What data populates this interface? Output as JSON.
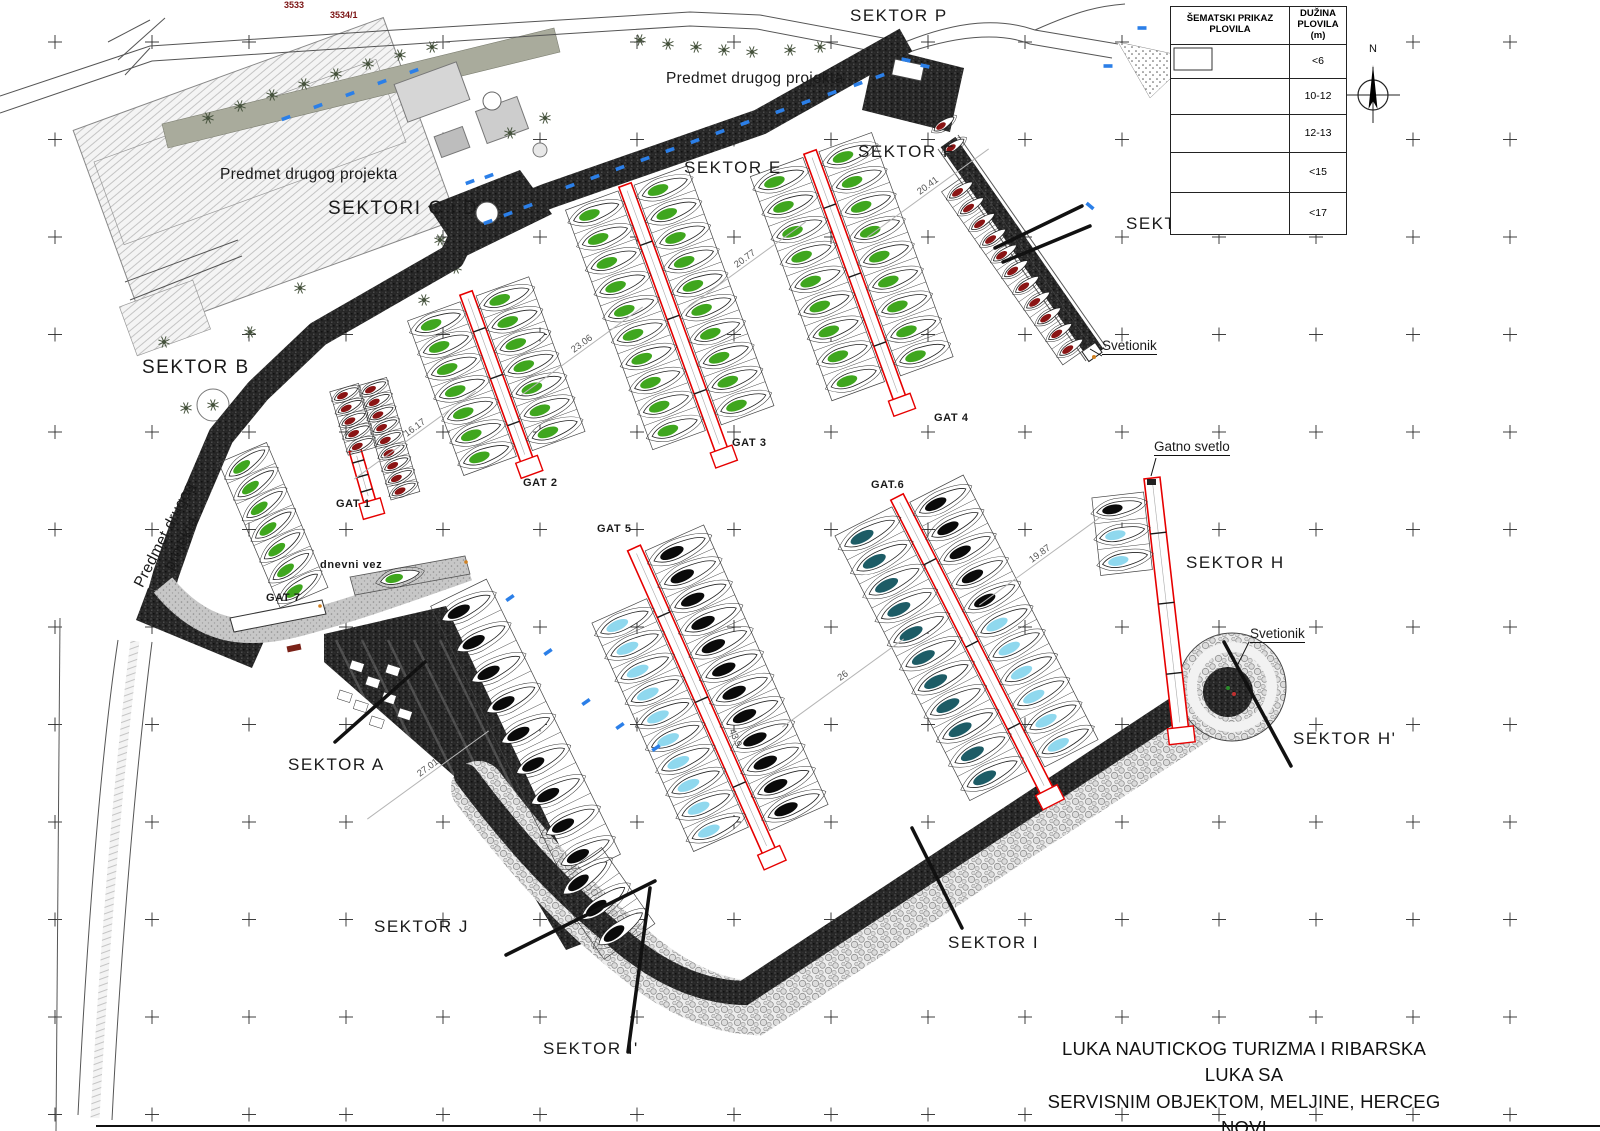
{
  "title_block": {
    "line1": "LUKA NAUTICKOG TURIZMA I RIBARSKA LUKA SA",
    "line2": "SERVISNIM OBJEKTOM, MELJINE, HERCEG NOVI"
  },
  "legend": {
    "header_left": "ŠEMATSKI PRIKAZ PLOVILA",
    "header_right": "DUŽINA PLOVILA (m)",
    "rows": [
      {
        "range": "<6",
        "color": "#8a1414"
      },
      {
        "range": "10-12",
        "color": "#3fa61e"
      },
      {
        "range": "12-13",
        "color": "#8fd8ee"
      },
      {
        "range": "<15",
        "color": "#0a0a0a"
      },
      {
        "range": "<17",
        "color": "#1d5c66"
      }
    ]
  },
  "north": {
    "label": "N"
  },
  "sectors": {
    "p": "SEKTOR P",
    "cid": "SEKTORI C i D",
    "e": "SEKTOR E",
    "f": "SEKTOR F",
    "g": "SEKTOR G",
    "b": "SEKTOR B",
    "a": "SEKTOR A",
    "h": "SEKTOR H",
    "h2": "SEKTOR H'",
    "i": "SEKTOR I",
    "i2": "SEKTOR I'",
    "j": "SEKTOR J"
  },
  "areas": {
    "predmet1": "Predmet drugog projekta",
    "predmet2": "Predmet drugog projekta",
    "predmet_rot_l1": "Predmet drugog",
    "predmet_rot_l2": "projekta"
  },
  "gats": {
    "g1": "GAT 1",
    "g2": "GAT 2",
    "g3": "GAT 3",
    "g4": "GAT 4",
    "g5": "GAT 5",
    "g6": "GAT.6",
    "g7": "GAT 7",
    "dnevni": "dnevni vez"
  },
  "annotations": {
    "svetionik_top": "Svetionik",
    "svetionik_bottom": "Svetionik",
    "gatno_svetlo": "Gatno svetlo"
  },
  "dims": [
    {
      "value": "16.17"
    },
    {
      "value": "23.06"
    },
    {
      "value": "20.77"
    },
    {
      "value": "20.41"
    },
    {
      "value": "19.87"
    },
    {
      "value": "26"
    },
    {
      "value": "27.01"
    },
    {
      "value": "43.9"
    }
  ],
  "parcels": [
    {
      "id": "3533"
    },
    {
      "id": "3534/1"
    }
  ],
  "colors": {
    "pier_outline": "#e60000",
    "car_blue": "#2b7fe8",
    "quay_dark": "#262626",
    "section_line": "#111111",
    "tree_green": "#45523c"
  }
}
